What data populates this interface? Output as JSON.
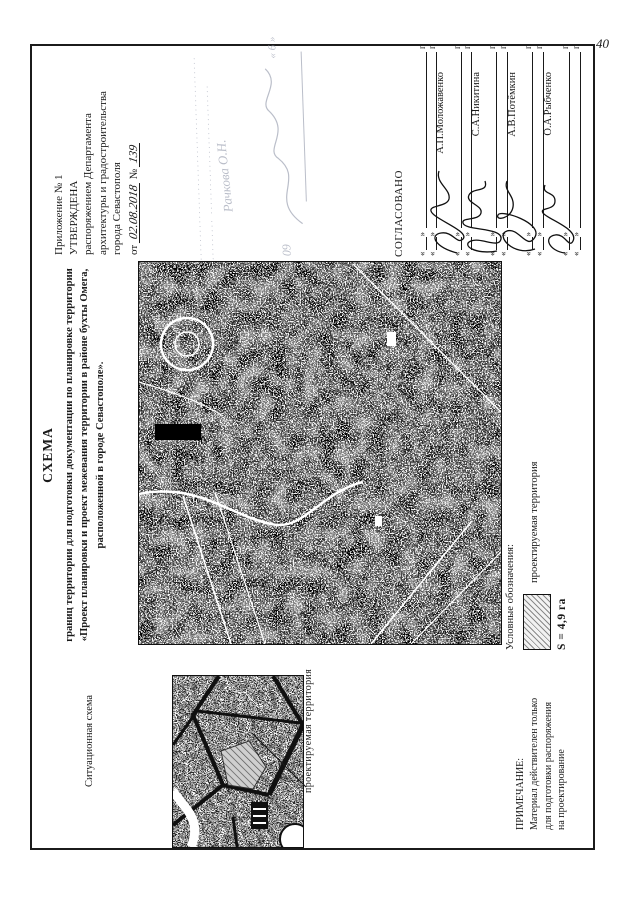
{
  "page": {
    "number": "40"
  },
  "approval": {
    "line1": "Приложение № 1",
    "line2": "УТВЕРЖДЕНА",
    "line3": "распоряжением Департамента",
    "line4": "архитектуры и градостроительства",
    "line5": "города Севастополя",
    "date_prefix": "от",
    "date_value": "02.08.2018",
    "number_prefix": "№",
    "number_value": "139"
  },
  "stamp": {
    "dots1": "·············································",
    "dots2": "··········  ····························",
    "signature": "Рачкова О.Н.",
    "date_digits": "09",
    "quote": "« 6 »"
  },
  "title": {
    "heading": "СХЕМА",
    "line1": "границ территории для подготовки документации по планировке территории",
    "line2": "«Проект планировки и проект межевания территории в районе бухты Омега,",
    "line3": "расположенной в городе Севастополе»."
  },
  "situational": {
    "label": "Ситуационная схема",
    "pointer_label": "проектируемая территория"
  },
  "legend": {
    "heading": "Условные обозначения:",
    "item_label": "проектируемая территория",
    "area": "S = 4,9 га"
  },
  "note": {
    "heading": "ПРИМЕЧАНИЕ:",
    "line1": "Материал действителен только",
    "line2": "для подготовки распоряжения",
    "line3": "на проектирование"
  },
  "approved_by": {
    "heading": "СОГЛАСОВАНО",
    "date_open": "«",
    "date_close": "»",
    "year_suffix": "г.",
    "signers": [
      {
        "name": "А.П.Моложавенко"
      },
      {
        "name": "С.А.Никитина"
      },
      {
        "name": "А.В.Потёмкин"
      },
      {
        "name": "О.А.Рыбченко"
      }
    ]
  },
  "colors": {
    "ink": "#1a1a1a",
    "paper": "#ffffff",
    "stamp": "#8d93a6"
  }
}
